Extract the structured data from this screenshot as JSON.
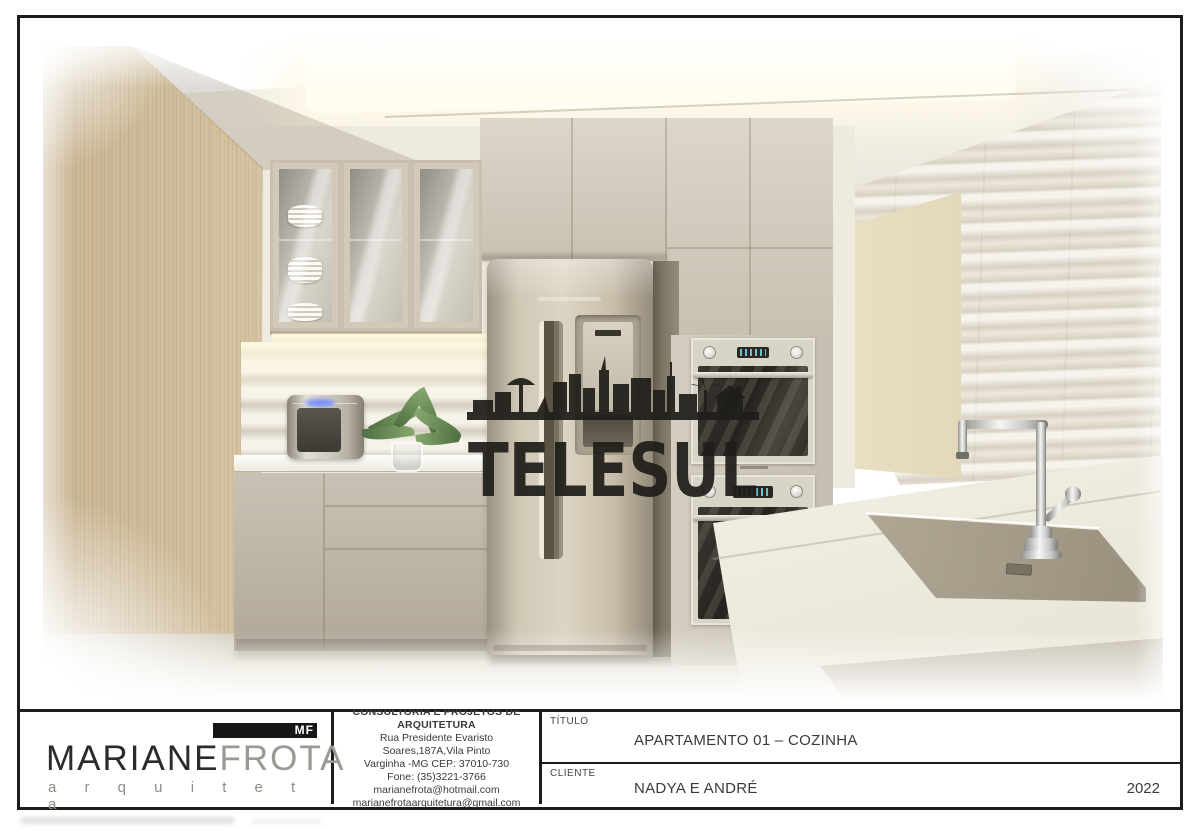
{
  "sheet": {
    "watermark_text": "TELESUL",
    "year": "2022",
    "logo": {
      "monogram": "MF",
      "name_first": "MARIANE",
      "name_last": "FROTA",
      "profession": "a r q u i t e t a"
    },
    "office": {
      "lines": [
        "CONSULTORIA E PROJETOS DE ARQUITETURA",
        "Rua Presidente Evaristo Soares,187A,Vila Pinto",
        "Varginha -MG  CEP: 37010-730",
        "Fone: (35)3221-3766",
        "marianefrota@hotmail.com",
        "marianefrotaarquitetura@gmail.com"
      ]
    },
    "fields": {
      "title_label": "TÍTULO",
      "title_value": "APARTAMENTO 01 – COZINHA",
      "client_label": "CLIENTE",
      "client_value": "NADYA E ANDRÉ"
    },
    "colors": {
      "border": "#1c1c1c",
      "wood": "#e2d4b4",
      "cabinet": "#c0b7a8",
      "counter": "#f7f5f0",
      "led_glow": "#fff5d0",
      "watermark": "#201e1a"
    }
  }
}
